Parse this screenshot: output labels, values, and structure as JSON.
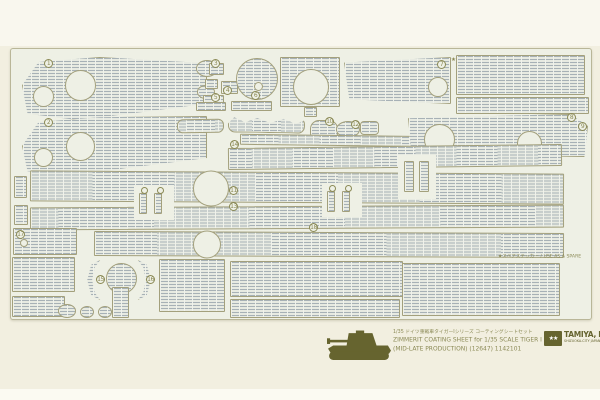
{
  "product": {
    "caption_jp": "1/35 ドイツ重戦車タイガーIシリーズ コーティングシートセット",
    "caption_en1": "ZIMMERIT COATING SHEET for 1/35 SCALE TIGER I",
    "caption_en2": "(MID-LATE PRODUCTION) (12647) 1142101",
    "spare_label": "★スペアステッカー / USE AS A SPARE",
    "star": "★",
    "logo": {
      "stars": "★★",
      "name": "TAMIYA, INC.",
      "sub": "SHIZUOKA-CITY JAPAN"
    }
  },
  "colors": {
    "page_bg": "#f2efe0",
    "sheet_bg": "#eef0e5",
    "texture_line": "#a7b1b6",
    "outline": "#a3a07c",
    "ink": "#8b8a56",
    "dark_ink": "#66642f"
  },
  "sheet": {
    "x": 10,
    "y": 48,
    "w": 582,
    "h": 272
  },
  "pieces": [
    {
      "x": 22,
      "y": 57,
      "w": 185,
      "h": 63,
      "clip": "polygon(0% 45%, 9% 8%, 42% 0%, 100% 10%, 100% 74%, 58% 90%, 30% 100%, 3% 90%)",
      "holes": [
        {
          "cx": 20,
          "cy": 38,
          "d": 21
        },
        {
          "cx": 57,
          "cy": 27,
          "d": 31
        }
      ]
    },
    {
      "x": 22,
      "y": 116,
      "w": 185,
      "h": 60,
      "clip": "polygon(0% 50%, 9% 10%, 42% 2%, 100% 0%, 100% 70%, 58% 86%, 30% 100%, 3% 92%)",
      "holes": [
        {
          "cx": 20,
          "cy": 40,
          "d": 19
        },
        {
          "cx": 57,
          "cy": 29,
          "d": 29
        }
      ]
    },
    {
      "x": 196,
      "y": 60,
      "w": 22,
      "h": 17,
      "shape": "oval"
    },
    {
      "x": 197,
      "y": 85,
      "w": 18,
      "h": 14,
      "shape": "oval"
    },
    {
      "x": 209,
      "y": 63,
      "w": 15,
      "h": 12
    },
    {
      "x": 205,
      "y": 79,
      "w": 13,
      "h": 10
    },
    {
      "x": 221,
      "y": 81,
      "w": 17,
      "h": 13
    },
    {
      "x": 203,
      "y": 95,
      "w": 21,
      "h": 9
    },
    {
      "x": 236,
      "y": 58,
      "d": 42,
      "shape": "circle",
      "holes": [
        {
          "cx": 21,
          "cy": 27,
          "d": 9
        }
      ]
    },
    {
      "x": 280,
      "y": 57,
      "w": 60,
      "h": 50,
      "holes": [
        {
          "cx": 30,
          "cy": 29,
          "d": 36
        }
      ]
    },
    {
      "x": 304,
      "y": 107,
      "w": 13,
      "h": 10
    },
    {
      "x": 196,
      "y": 102,
      "w": 30,
      "h": 9
    },
    {
      "x": 231,
      "y": 101,
      "w": 41,
      "h": 10
    },
    {
      "x": 344,
      "y": 57,
      "w": 107,
      "h": 47,
      "clip": "polygon(0% 12%, 100% 0%, 100% 100%, 5% 90%)",
      "holes": [
        {
          "cx": 93,
          "cy": 29,
          "d": 20
        }
      ]
    },
    {
      "x": 456,
      "y": 55,
      "w": 129,
      "h": 40
    },
    {
      "x": 456,
      "y": 97,
      "w": 133,
      "h": 17
    },
    {
      "x": 228,
      "y": 117,
      "w": 77,
      "h": 16,
      "rad": 7,
      "rot": 1,
      "clip": "polygon(0% 45%, 8% 5%, 22% 35%, 38% 8%, 55% 38%, 72% 10%, 88% 40%, 100% 15%, 100% 100%, 0% 100%)"
    },
    {
      "x": 177,
      "y": 119,
      "w": 47,
      "h": 14,
      "rad": 6,
      "rot": -1
    },
    {
      "x": 310,
      "y": 120,
      "w": 28,
      "h": 22,
      "rad": 9
    },
    {
      "x": 336,
      "y": 121,
      "w": 24,
      "h": 17,
      "shape": "oval"
    },
    {
      "x": 360,
      "y": 121,
      "w": 19,
      "h": 14,
      "rad": 4
    },
    {
      "x": 240,
      "y": 135,
      "w": 200,
      "h": 11,
      "rot": 0.7
    },
    {
      "x": 408,
      "y": 114,
      "w": 180,
      "h": 43,
      "clip": "polygon(0% 10%, 90% 0%, 100% 28%, 98% 100%, 2% 94%)",
      "holes": [
        {
          "cx": 30,
          "cy": 24,
          "d": 31
        },
        {
          "cx": 120,
          "cy": 28,
          "d": 25
        }
      ]
    },
    {
      "x": 228,
      "y": 146,
      "w": 334,
      "h": 22,
      "rot": -0.7
    },
    {
      "x": 30,
      "y": 172,
      "w": 534,
      "h": 31,
      "rot": 0.35,
      "holes": [
        {
          "cx": 180,
          "cy": 16,
          "d": 36
        }
      ]
    },
    {
      "x": 30,
      "y": 206,
      "w": 534,
      "h": 23,
      "rot": -0.3
    },
    {
      "x": 94,
      "y": 232,
      "w": 470,
      "h": 25,
      "rot": 0.25,
      "holes": [
        {
          "cx": 112,
          "cy": 12,
          "d": 28
        }
      ]
    },
    {
      "x": 14,
      "y": 176,
      "w": 13,
      "h": 22
    },
    {
      "x": 14,
      "y": 205,
      "w": 14,
      "h": 20
    },
    {
      "x": 13,
      "y": 228,
      "w": 64,
      "h": 27,
      "holes": [
        {
          "cx": 10,
          "cy": 14,
          "d": 8
        }
      ]
    },
    {
      "x": 12,
      "y": 257,
      "w": 63,
      "h": 35
    },
    {
      "x": 12,
      "y": 296,
      "w": 53,
      "h": 21
    },
    {
      "x": 84,
      "y": 260,
      "w": 18,
      "h": 40,
      "clip": "polygon(90% 0%, 40% 12%, 18% 50%, 40% 88%, 90% 100%, 60% 82%, 45% 50%, 60% 18%)"
    },
    {
      "x": 136,
      "y": 260,
      "w": 18,
      "h": 40,
      "clip": "polygon(10% 0%, 60% 12%, 82% 50%, 60% 88%, 10% 100%, 40% 82%, 55% 50%, 40% 18%)"
    },
    {
      "x": 106,
      "y": 263,
      "d": 31,
      "shape": "circle"
    },
    {
      "x": 112,
      "y": 287,
      "w": 17,
      "h": 31
    },
    {
      "x": 159,
      "y": 259,
      "w": 66,
      "h": 53
    },
    {
      "x": 230,
      "y": 261,
      "w": 173,
      "h": 36
    },
    {
      "x": 230,
      "y": 299,
      "w": 170,
      "h": 19
    },
    {
      "x": 402,
      "y": 263,
      "w": 158,
      "h": 53
    },
    {
      "x": 58,
      "y": 304,
      "w": 18,
      "h": 14,
      "shape": "oval"
    },
    {
      "x": 80,
      "y": 306,
      "w": 14,
      "h": 12,
      "shape": "oval"
    },
    {
      "x": 98,
      "y": 306,
      "w": 14,
      "h": 12,
      "shape": "oval"
    },
    {
      "x": 134,
      "y": 185,
      "w": 40,
      "h": 35,
      "blank": true
    },
    {
      "x": 139,
      "y": 193,
      "w": 8,
      "h": 21
    },
    {
      "x": 154,
      "y": 193,
      "w": 8,
      "h": 21
    },
    {
      "x": 322,
      "y": 183,
      "w": 40,
      "h": 34,
      "blank": true
    },
    {
      "x": 327,
      "y": 191,
      "w": 8,
      "h": 21
    },
    {
      "x": 342,
      "y": 191,
      "w": 8,
      "h": 21
    },
    {
      "x": 398,
      "y": 155,
      "w": 38,
      "h": 44,
      "blank": true
    },
    {
      "x": 404,
      "y": 161,
      "w": 10,
      "h": 31
    },
    {
      "x": 419,
      "y": 161,
      "w": 10,
      "h": 31
    }
  ],
  "bolts": [
    {
      "x": 141,
      "y": 187
    },
    {
      "x": 157,
      "y": 187
    },
    {
      "x": 329,
      "y": 185
    },
    {
      "x": 345,
      "y": 185
    }
  ],
  "markers": [
    {
      "n": "1",
      "x": 44,
      "y": 59
    },
    {
      "n": "2",
      "x": 44,
      "y": 118
    },
    {
      "n": "3",
      "x": 211,
      "y": 59
    },
    {
      "n": "4",
      "x": 223,
      "y": 86
    },
    {
      "n": "5",
      "x": 211,
      "y": 93
    },
    {
      "n": "6",
      "x": 251,
      "y": 91
    },
    {
      "n": "7",
      "x": 437,
      "y": 60
    },
    {
      "n": "8",
      "x": 567,
      "y": 113
    },
    {
      "n": "9",
      "x": 578,
      "y": 122
    },
    {
      "n": "10",
      "x": 325,
      "y": 117
    },
    {
      "n": "11",
      "x": 229,
      "y": 186
    },
    {
      "n": "12",
      "x": 351,
      "y": 120
    },
    {
      "n": "13",
      "x": 229,
      "y": 202
    },
    {
      "n": "14",
      "x": 230,
      "y": 140
    },
    {
      "n": "15",
      "x": 96,
      "y": 275
    },
    {
      "n": "16",
      "x": 146,
      "y": 275
    },
    {
      "n": "17",
      "x": 16,
      "y": 230
    },
    {
      "n": "18",
      "x": 309,
      "y": 223
    }
  ]
}
